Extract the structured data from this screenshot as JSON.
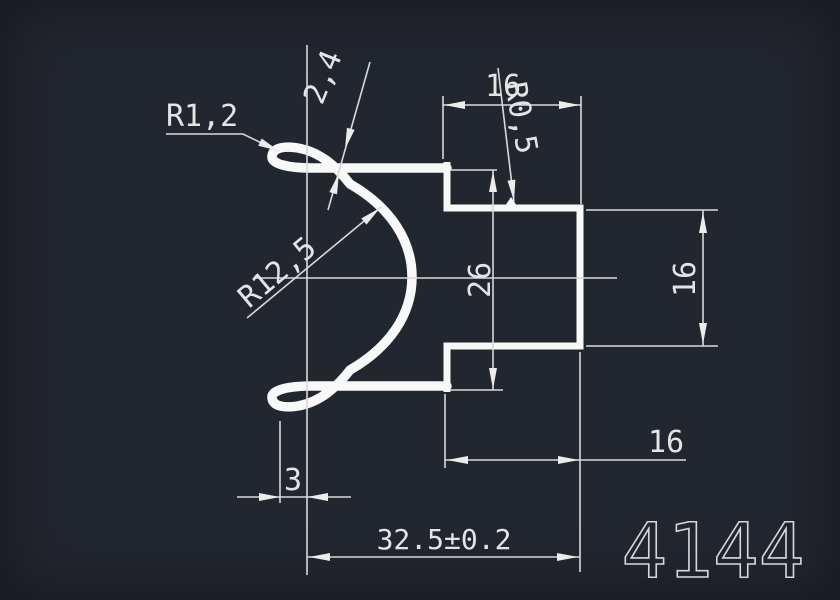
{
  "drawing": {
    "number": "4144",
    "labels": {
      "radius_hook_tip": "R1,2",
      "hook_thickness": "2,4",
      "radius_main": "R12,5",
      "radius_corner": "R0,5",
      "width_top": "16",
      "height_opening": "26",
      "height_right": "16",
      "width_step": "16",
      "hook_offset": "3",
      "width_overall": "32.5±0.2"
    },
    "colors": {
      "background": "#22262e",
      "profile_line": "#f8f8f8",
      "thin_line": "#d8d8d8",
      "text": "#e4e4e4"
    }
  }
}
